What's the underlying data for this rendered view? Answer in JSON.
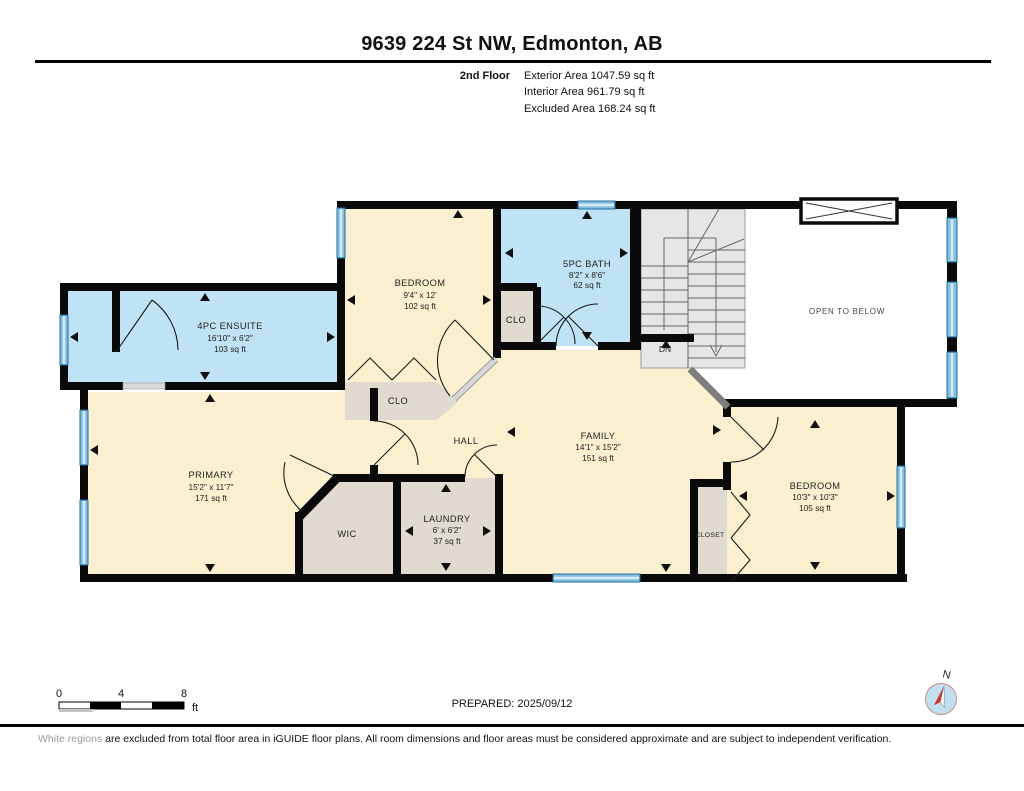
{
  "header": {
    "title": "9639 224 St NW, Edmonton, AB",
    "floor_label": "2nd Floor",
    "exterior_area": "Exterior Area 1047.59 sq ft",
    "interior_area": "Interior Area 961.79 sq ft",
    "excluded_area": "Excluded Area 168.24 sq ft"
  },
  "rooms": [
    {
      "id": "ensuite",
      "name": "4PC ENSUITE",
      "dims": "16'10\" x 6'2\"",
      "area": "103 sq ft"
    },
    {
      "id": "bedroom-top",
      "name": "BEDROOM",
      "dims": "9'4\" x 12'",
      "area": "102 sq ft"
    },
    {
      "id": "bath",
      "name": "5PC BATH",
      "dims": "8'2\" x 8'6\"",
      "area": "62 sq ft"
    },
    {
      "id": "clo-bath",
      "name": "CLO"
    },
    {
      "id": "clo-bedroom",
      "name": "CLO"
    },
    {
      "id": "open-below",
      "name": "OPEN TO BELOW"
    },
    {
      "id": "stairs",
      "name": "DN"
    },
    {
      "id": "primary",
      "name": "PRIMARY",
      "dims": "15'2\" x 11'7\"",
      "area": "171 sq ft"
    },
    {
      "id": "hall",
      "name": "HALL"
    },
    {
      "id": "family",
      "name": "FAMILY",
      "dims": "14'1\" x 15'2\"",
      "area": "151 sq ft"
    },
    {
      "id": "wic",
      "name": "WIC"
    },
    {
      "id": "laundry",
      "name": "LAUNDRY",
      "dims": "6' x 6'2\"",
      "area": "37 sq ft"
    },
    {
      "id": "closet",
      "name": "CLOSET"
    },
    {
      "id": "bedroom-right",
      "name": "BEDROOM",
      "dims": "10'3\" x 10'3\"",
      "area": "105 sq ft"
    }
  ],
  "footer": {
    "prepared": "PREPARED: 2025/09/12",
    "disclaimer_prefix": "White regions",
    "disclaimer_rest": " are excluded from total floor area in iGUIDE floor plans. All room dimensions and floor areas must be considered approximate and are subject to independent verification.",
    "scale": {
      "t0": "0",
      "t4": "4",
      "t8": "8",
      "unit": "ft"
    },
    "compass_label": "N"
  },
  "colors": {
    "wall": "#0a0a0a",
    "room_beige": "#FAF0CF",
    "room_blue": "#BFE2F5",
    "room_gray": "#E0DAD0",
    "stairs_gray": "#E6E6E6",
    "window_blue": "#86BEE0",
    "compass_red": "#D03328"
  }
}
